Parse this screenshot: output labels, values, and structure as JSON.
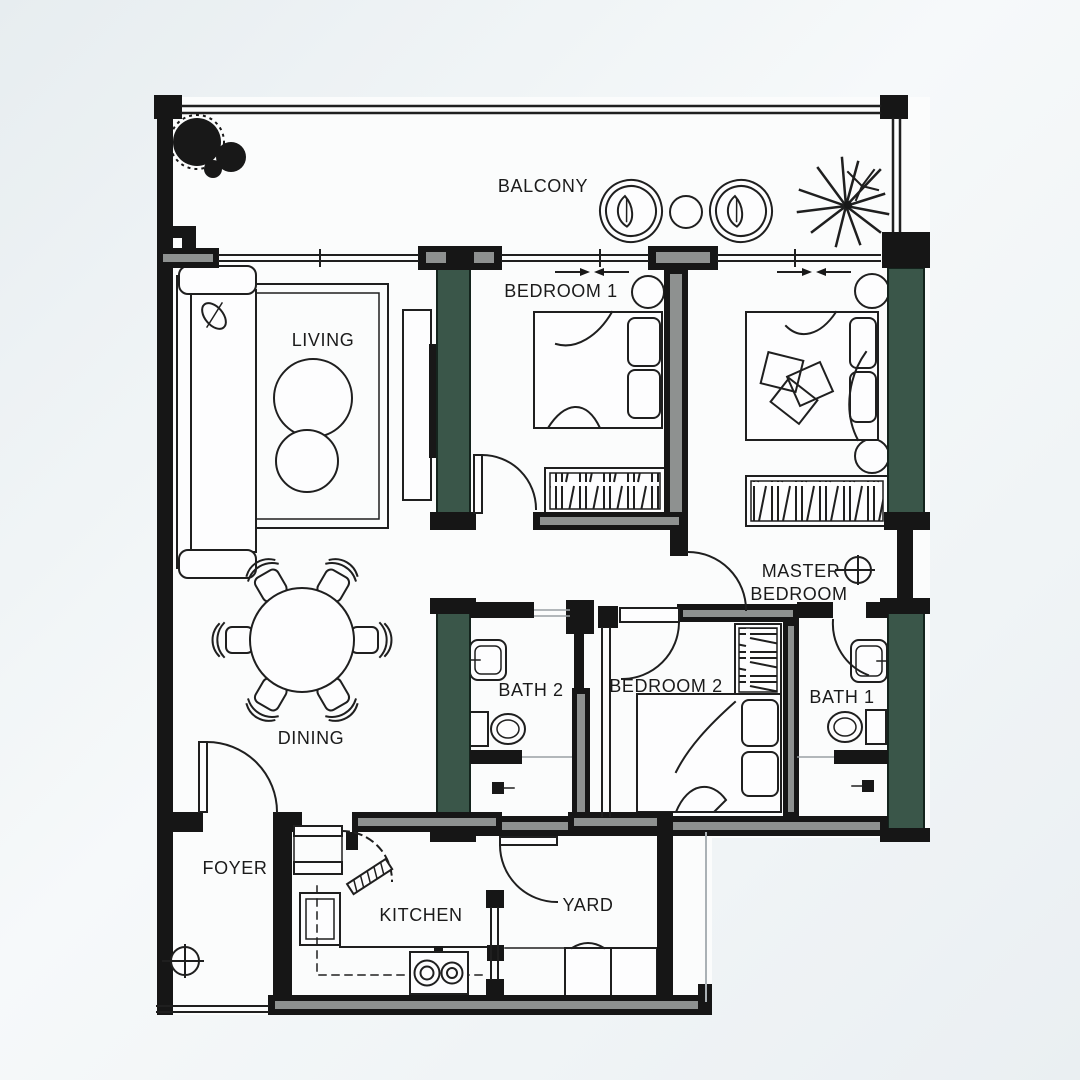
{
  "meta": {
    "type": "apartment-floor-plan"
  },
  "colors": {
    "wall": "#161616",
    "structure_green": "#3a5649",
    "paper": "#fbfcfc",
    "background_tint": "#e9eef1",
    "line": "#1f1f1f"
  },
  "icons": {
    "light_point": "circle-plus",
    "sliding_door_arrows": "opposing-arrows",
    "plant": "palm-starburst",
    "tree": "filled-canopy"
  },
  "rooms": {
    "balcony": {
      "label": "BALCONY"
    },
    "living": {
      "label": "LIVING"
    },
    "dining": {
      "label": "DINING"
    },
    "bedroom1": {
      "label": "BEDROOM 1"
    },
    "master_bedroom": {
      "label_line1": "MASTER",
      "label_line2": "BEDROOM"
    },
    "bedroom2": {
      "label": "BEDROOM 2"
    },
    "bath1": {
      "label": "BATH 1"
    },
    "bath2": {
      "label": "BATH 2"
    },
    "foyer": {
      "label": "FOYER"
    },
    "kitchen": {
      "label": "KITCHEN"
    },
    "yard": {
      "label": "YARD"
    }
  }
}
